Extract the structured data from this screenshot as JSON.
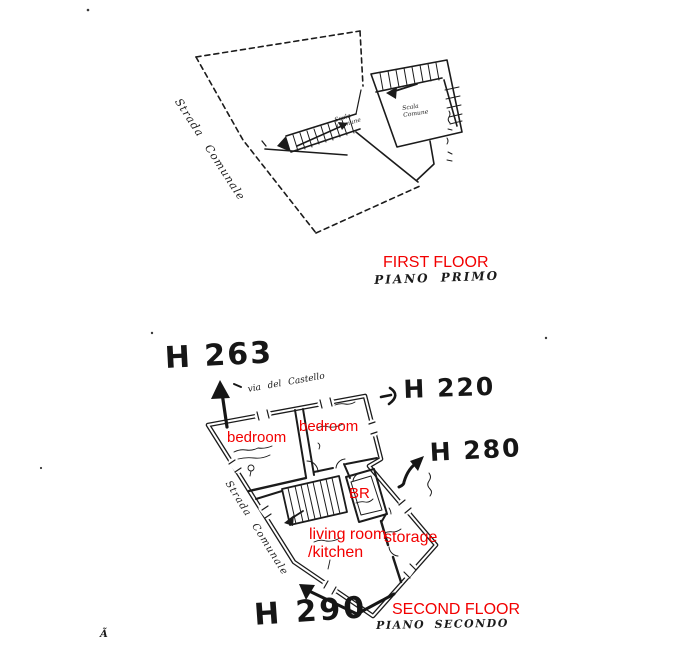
{
  "colors": {
    "ink": "#1b1b1b",
    "annotation_red": "#f20000",
    "paper": "#ffffff"
  },
  "ff": {
    "title": "FIRST FLOOR",
    "subtitle": "PIANO PRIMO",
    "street": "Strada Comunale",
    "scala_main": "Scala Comune",
    "scala_right": "Scala Comune"
  },
  "sf": {
    "title": "SECOND FLOOR",
    "subtitle": "PIANO SECONDO",
    "street": "Strada Comunale",
    "via": "via del Castello",
    "bedroom_left": "bedroom",
    "bedroom_right": "bedroom",
    "bathroom": "BR",
    "living1": "living room",
    "living2": "/kitchen",
    "storage": "storage",
    "h263": "H 263",
    "h220": "H 220",
    "h280": "H 280",
    "h290": "H 290"
  },
  "corner_mark": "Ã"
}
